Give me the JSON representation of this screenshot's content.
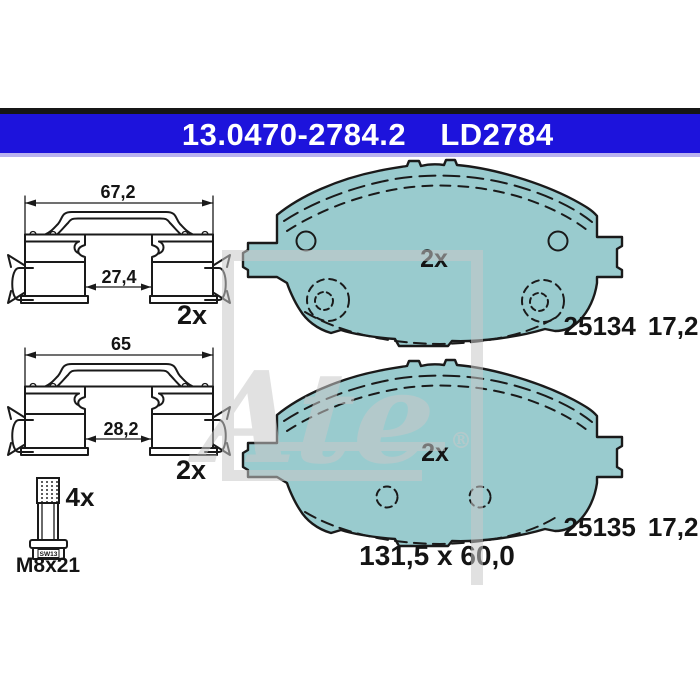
{
  "header": {
    "part_number": "13.0470-2784.2",
    "reference_code": "LD2784",
    "bar_color": "#1d13dc"
  },
  "colors": {
    "pad_friction": "#99cbce",
    "line": "#1a1a1a",
    "watermark_gray": "#c9c9c9",
    "header_blue": "#1d13dc"
  },
  "clips": [
    {
      "outer_width_label": "67,2",
      "inner_width_label": "27,4",
      "quantity_label": "2x"
    },
    {
      "outer_width_label": "65",
      "inner_width_label": "28,2",
      "quantity_label": "2x"
    }
  ],
  "bolt": {
    "quantity_label": "4x",
    "thread_size_label": "M8x21",
    "wrench_size_label": "SW13"
  },
  "pads": [
    {
      "quantity_label": "2x",
      "wva_number": "25134",
      "thickness_label": "17,2"
    },
    {
      "quantity_label": "2x",
      "wva_number": "25135",
      "thickness_label": "17,2"
    }
  ],
  "pad_dimensions_label": "131,5 x 60,0",
  "watermark": {
    "brand_text": "Ate",
    "registered_mark": "®"
  }
}
